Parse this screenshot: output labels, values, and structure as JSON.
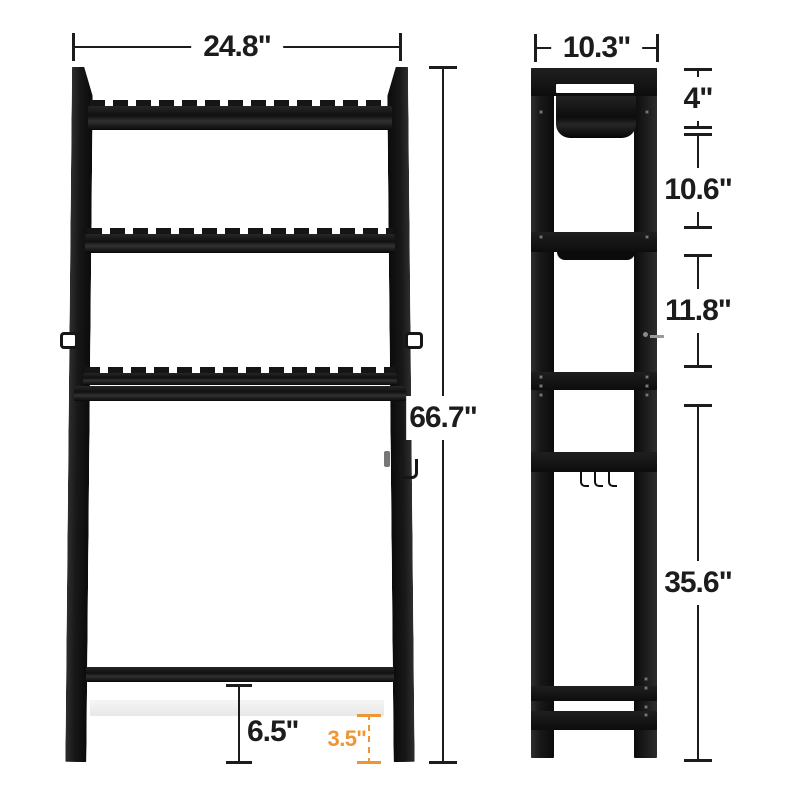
{
  "front_view": {
    "width_label": "24.8\"",
    "height_label": "66.7\"",
    "inner_clearance_label": "6.5''",
    "base_clearance_label": "3.5''"
  },
  "side_view": {
    "depth_label": "10.3\"",
    "top_section_label": "4\"",
    "upper_section_label": "10.6\"",
    "middle_section_label": "11.8\"",
    "lower_section_label": "35.6\""
  },
  "colors": {
    "ink": "#1c1c1c",
    "rack_black": "#141414",
    "accent_orange": "#ED9537",
    "shelf_white": "#f0f0f0"
  }
}
